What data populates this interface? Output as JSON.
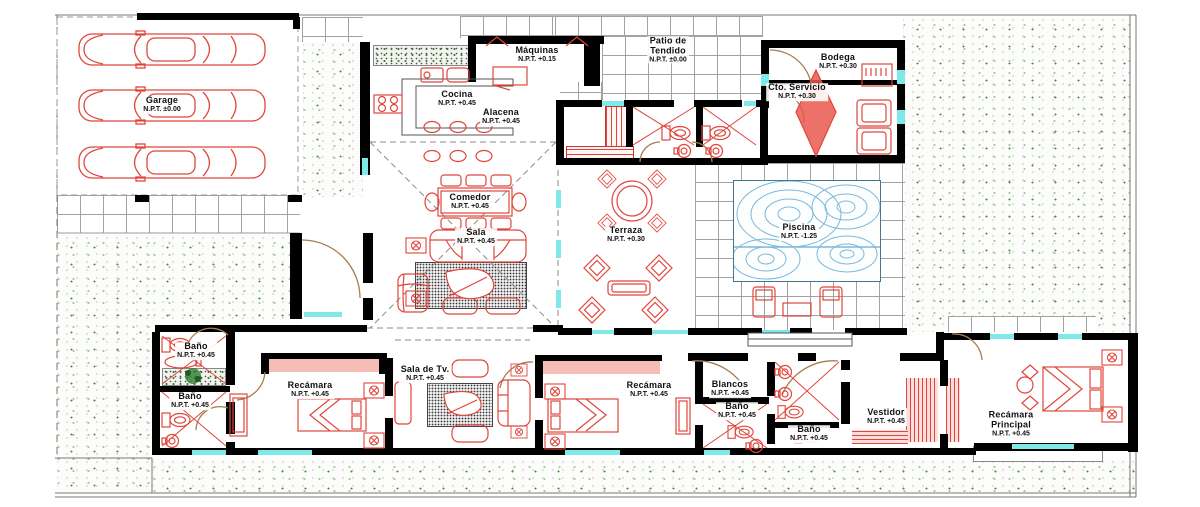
{
  "drawing": {
    "type": "architectural-floor-plan",
    "colors": {
      "walls": "#000000",
      "furniture_red": "#e0453c",
      "window_cyan": "#7fe9e9",
      "closet_pink": "#f6bcb6",
      "grass_green": "#3c8a3c",
      "pool_blue": "#79b8dc",
      "door_tan": "#a87c52"
    }
  },
  "rooms": {
    "garage": {
      "name": "Garage",
      "npt": "N.P.T. ±0.00"
    },
    "maquinas": {
      "name": "Máquinas",
      "npt": "N.P.T. +0.15"
    },
    "cocina": {
      "name": "Cocina",
      "npt": "N.P.T. +0.45"
    },
    "alacena": {
      "name": "Alacena",
      "npt": "N.P.T. +0.45"
    },
    "patio": {
      "name": "Patio de",
      "name2": "Tendido",
      "npt": "N.P.T. ±0.00"
    },
    "bodega": {
      "name": "Bodega",
      "npt": "N.P.T. +0.30"
    },
    "cto_servicio": {
      "name": "Cto. Servicio",
      "npt": "N.P.T. +0.30"
    },
    "comedor": {
      "name": "Comedor",
      "npt": "N.P.T. +0.45"
    },
    "sala": {
      "name": "Sala",
      "npt": "N.P.T. +0.45"
    },
    "terraza": {
      "name": "Terraza",
      "npt": "N.P.T. +0.30"
    },
    "piscina": {
      "name": "Piscina",
      "npt": "N.P.T. -1.25"
    },
    "bano_izq_1": {
      "name": "Baño",
      "npt": "N.P.T. +0.45"
    },
    "bano_izq_2": {
      "name": "Baño",
      "npt": "N.P.T. +0.45"
    },
    "recamara_1": {
      "name": "Recámara",
      "npt": "N.P.T. +0.45"
    },
    "sala_tv": {
      "name": "Sala de Tv.",
      "npt": "N.P.T. +0.45"
    },
    "recamara_2": {
      "name": "Recámara",
      "npt": "N.P.T. +0.45"
    },
    "blancos": {
      "name": "Blancos",
      "npt": "N.P.T. +0.45"
    },
    "bano_3": {
      "name": "Baño",
      "npt": "N.P.T. +0.45"
    },
    "bano_4": {
      "name": "Baño",
      "npt": "N.P.T. +0.45"
    },
    "vestidor": {
      "name": "Vestidor",
      "npt": "N.P.T. +0.45"
    },
    "recamara_principal": {
      "name": "Recámara",
      "name2": "Principal",
      "npt": "N.P.T. +0.45"
    }
  }
}
